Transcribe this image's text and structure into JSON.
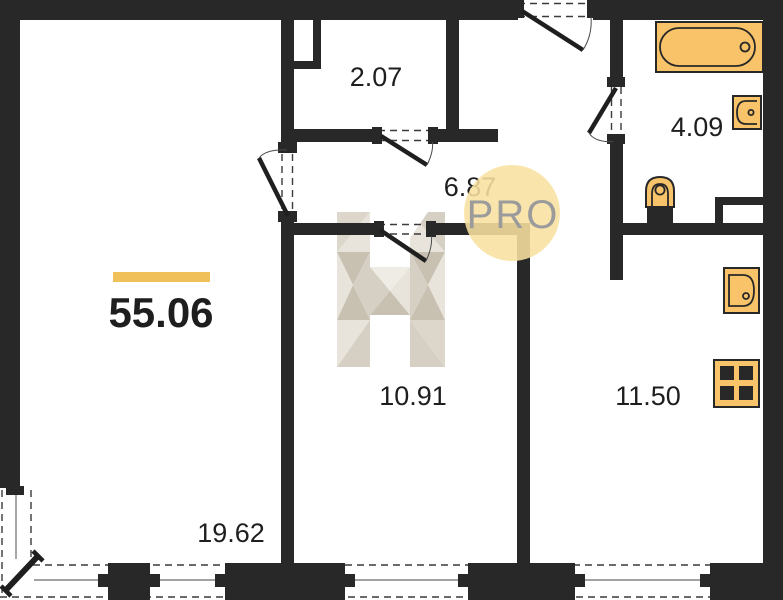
{
  "plan": {
    "title_area": "55.06",
    "rooms": [
      {
        "id": "closet",
        "area": "2.07"
      },
      {
        "id": "hallway",
        "area": "6.87"
      },
      {
        "id": "bathroom",
        "area": "4.09"
      },
      {
        "id": "bedroom",
        "area": "10.91"
      },
      {
        "id": "kitchen",
        "area": "11.50"
      },
      {
        "id": "living-room",
        "area": "19.62"
      }
    ],
    "badge": "PRO",
    "watermark_logo": "H-monogram",
    "fixtures": [
      "bathtub-icon",
      "bath-sink-icon",
      "toilet-icon",
      "kitchen-sink-icon",
      "stove-icon"
    ],
    "colors": {
      "wall": "#282828",
      "fixture": "#F9C369",
      "accent": "#F0C05A",
      "badge-bg": "#F8E1A1",
      "badge-text": "#9B9B9B",
      "label": "#1E1E1E",
      "wm-light": "#E8E4DB",
      "wm-mid": "#D6D0C4",
      "wm-dark": "#C8C1B2"
    }
  }
}
